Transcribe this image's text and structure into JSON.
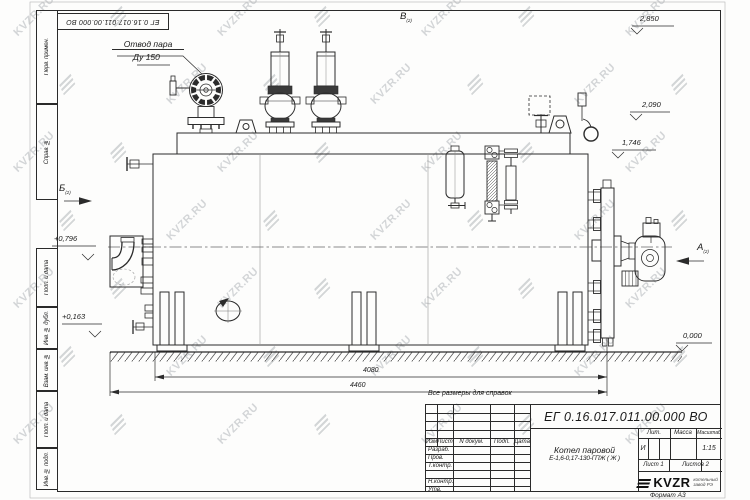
{
  "watermark": {
    "text": "KVZR.RU"
  },
  "frame": {
    "margin_cells": [
      "Перв. примен.",
      "Справ. №",
      "Подп. и дата",
      "Инв. № дубл.",
      "Взам. инв. №",
      "Подп. и дата",
      "Инв. № подл."
    ]
  },
  "drawing": {
    "steam_outlet_label": [
      "Отвод пара",
      "Ду 150"
    ],
    "note": "Все размеры для справок",
    "views": {
      "top": "В",
      "front": "Б",
      "rear": "А",
      "sheet_ref": "(2)"
    },
    "elevations": {
      "valve_top": "2,850",
      "deck_upper": "2,090",
      "deck": "1,746",
      "nozzle": "+0,796",
      "lower": "+0,163",
      "ground": "0,000"
    },
    "dimensions": {
      "shell_length": "4080",
      "overall_length": "4460"
    }
  },
  "title_block": {
    "doc_number": "ЕГ 0.16.017.011.00.000 ВО",
    "product_name": "Котел паровой",
    "product_type": "Е-1,6-0,17-130-ГПЖ ( Ж )",
    "header_cols": [
      "Изм",
      "Лист",
      "N докум.",
      "Подп.",
      "Дата"
    ],
    "signature_rows": [
      "Разраб.",
      "Пров.",
      "Т.контр.",
      "",
      "Н.контр.",
      "Утв."
    ],
    "lit_label": "Лит.",
    "mass_label": "Масса",
    "scale_label": "Масштаб",
    "lit_value": "И",
    "scale_value": "1:15",
    "sheet_info": "Лист 1",
    "sheets_info": "Листов 2",
    "logo_text": "KVZR",
    "logo_subtext": "котельный завод РЭ",
    "format_note": "Формат А3"
  }
}
